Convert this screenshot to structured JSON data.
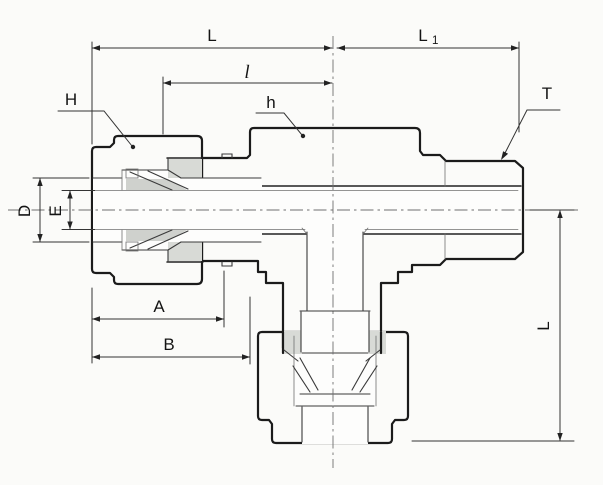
{
  "drawing": {
    "type": "technical-section-drawing",
    "subject": "male-run-tee-compression-fitting-cross-section",
    "labels": {
      "L_top": "L",
      "L1_main": "L",
      "L1_sub": "1",
      "l_inner": "l",
      "H": "H",
      "h": "h",
      "T": "T",
      "D": "D",
      "E": "E",
      "A": "A",
      "B": "B",
      "L_right": "L"
    },
    "colors": {
      "background": "#fbfbf9",
      "body_fill": "#d8dad6",
      "nut_fill": "#c6c8c4",
      "ferrule_fill": "#cfd1cd",
      "white": "#fdfdfc",
      "line": "#1b1b1b"
    }
  }
}
